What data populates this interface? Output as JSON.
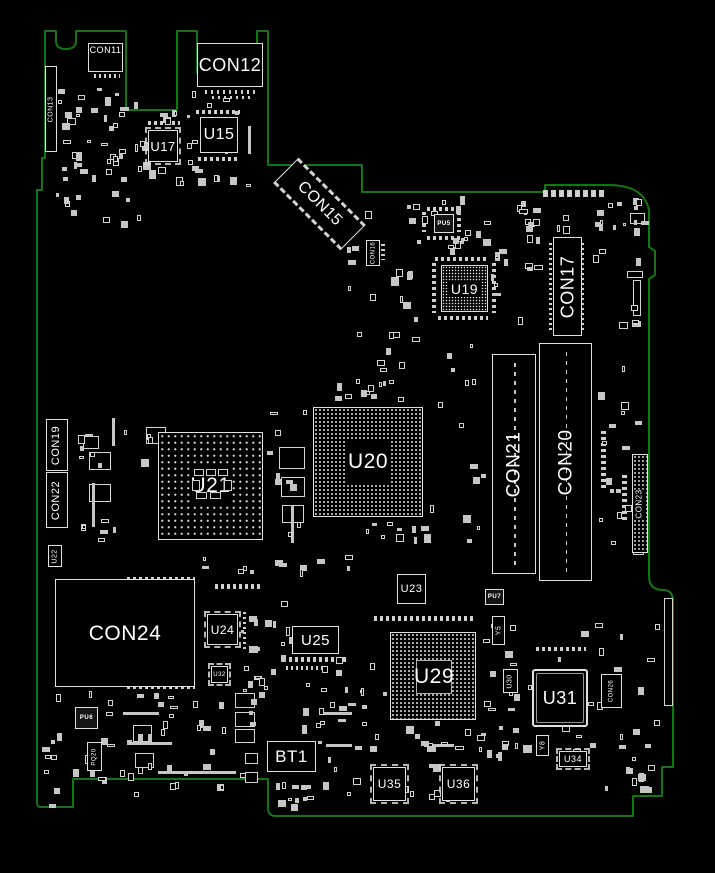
{
  "colors": {
    "background": "#000000",
    "board-outline": "#177317",
    "silkscreen": "#e0e0e0",
    "label": "#ffffff"
  },
  "board": {
    "outline_path": "M45,31 L56,31 L56,41 Q56,49 66,49 Q76,49 76,41 L76,31 L126,31 L126,110 L177,110 L177,31 L197,31 L197,73 L257,73 L257,31 L268,31 L268,165 L362,165 L362,192 L545,192 L545,185 L608,185 Q636,185 645,200 Q649,206 649,212 L649,247 L655,251 L655,275 L649,279 L649,576 Q649,590 663,590 Q673,590 673,601 L673,767 L662,767 L662,796 L633,796 L633,816 L276,816 Q268,816 268,808 L268,779 L73,779 L73,807 L41,807 Q37,807 37,803 L37,190 L42,190 L42,158 L45,158 Z",
    "edge_marker_1": {
      "cx": 199,
      "cy": 73,
      "r": 2.5
    },
    "edge_marker_2": {
      "cx": 255,
      "cy": 73,
      "r": 2.5
    }
  },
  "components": [
    {
      "ref": "CON13",
      "label": "CON13",
      "x": 45,
      "y": 66,
      "w": 12,
      "h": 86,
      "fs": 7,
      "style": "plain",
      "vert": true
    },
    {
      "ref": "CON11",
      "label": "CON11",
      "x": 88,
      "y": 43,
      "w": 35,
      "h": 29,
      "fs": 9,
      "style": "plain",
      "labelTop": true
    },
    {
      "ref": "CON12",
      "label": "CON12",
      "x": 197,
      "y": 43,
      "w": 66,
      "h": 44,
      "fs": 18,
      "style": "plain"
    },
    {
      "ref": "U15",
      "label": "U15",
      "x": 200,
      "y": 117,
      "w": 38,
      "h": 36,
      "fs": 16,
      "style": "plain"
    },
    {
      "ref": "U17",
      "label": "U17",
      "x": 148,
      "y": 130,
      "w": 30,
      "h": 32,
      "fs": 13,
      "style": "qfp"
    },
    {
      "ref": "CON15",
      "label": "CON15",
      "x": 272,
      "y": 186,
      "w": 95,
      "h": 36,
      "fs": 16,
      "style": "diag"
    },
    {
      "ref": "CON16",
      "label": "CON16",
      "x": 366,
      "y": 240,
      "w": 14,
      "h": 26,
      "fs": 6,
      "style": "plain",
      "vert": true
    },
    {
      "ref": "PU5",
      "label": "PU5",
      "x": 434,
      "y": 214,
      "w": 20,
      "h": 19,
      "fs": 6,
      "style": "dark"
    },
    {
      "ref": "U19",
      "label": "U19",
      "x": 441,
      "y": 265,
      "w": 47,
      "h": 47,
      "fs": 14,
      "style": "finegrid"
    },
    {
      "ref": "CON17",
      "label": "CON17",
      "x": 553,
      "y": 237,
      "w": 29,
      "h": 99,
      "fs": 18,
      "style": "plain",
      "vert": true
    },
    {
      "ref": "CON19",
      "label": "CON19",
      "x": 46,
      "y": 419,
      "w": 22,
      "h": 52,
      "fs": 11,
      "style": "plain",
      "vert": true
    },
    {
      "ref": "CON22",
      "label": "CON22",
      "x": 46,
      "y": 472,
      "w": 22,
      "h": 56,
      "fs": 11,
      "style": "plain",
      "vert": true
    },
    {
      "ref": "U22",
      "label": "U22",
      "x": 48,
      "y": 545,
      "w": 14,
      "h": 22,
      "fs": 7,
      "style": "plain",
      "vert": true
    },
    {
      "ref": "U21",
      "label": "U21",
      "x": 158,
      "y": 432,
      "w": 105,
      "h": 108,
      "fs": 21,
      "style": "dots"
    },
    {
      "ref": "U20",
      "label": "U20",
      "x": 313,
      "y": 407,
      "w": 110,
      "h": 110,
      "fs": 21,
      "style": "grid"
    },
    {
      "ref": "CON21",
      "label": "CON21",
      "x": 492,
      "y": 354,
      "w": 44,
      "h": 220,
      "fs": 19,
      "style": "slot",
      "vert": true
    },
    {
      "ref": "CON20",
      "label": "CON20",
      "x": 539,
      "y": 343,
      "w": 53,
      "h": 238,
      "fs": 19,
      "style": "slot",
      "vert": true
    },
    {
      "ref": "CON23",
      "label": "CON23",
      "x": 632,
      "y": 454,
      "w": 16,
      "h": 99,
      "fs": 8,
      "style": "dotted",
      "vert": true
    },
    {
      "ref": "CON24",
      "label": "CON24",
      "x": 55,
      "y": 579,
      "w": 140,
      "h": 108,
      "fs": 21,
      "style": "plain"
    },
    {
      "ref": "U23",
      "label": "U23",
      "x": 397,
      "y": 574,
      "w": 29,
      "h": 30,
      "fs": 11,
      "style": "plain"
    },
    {
      "ref": "U24",
      "label": "U24",
      "x": 207,
      "y": 614,
      "w": 31,
      "h": 31,
      "fs": 12,
      "style": "qfp"
    },
    {
      "ref": "U25",
      "label": "U25",
      "x": 292,
      "y": 626,
      "w": 47,
      "h": 28,
      "fs": 15,
      "style": "plain"
    },
    {
      "ref": "U32",
      "label": "U32",
      "x": 211,
      "y": 666,
      "w": 17,
      "h": 17,
      "fs": 6,
      "style": "qfp"
    },
    {
      "ref": "PU6",
      "label": "PU6",
      "x": 75,
      "y": 707,
      "w": 23,
      "h": 22,
      "fs": 6,
      "style": "dark"
    },
    {
      "ref": "PQ20",
      "label": "PQ20",
      "x": 87,
      "y": 742,
      "w": 15,
      "h": 29,
      "fs": 6,
      "style": "plain",
      "vert": true
    },
    {
      "ref": "U29",
      "label": "U29",
      "x": 390,
      "y": 632,
      "w": 86,
      "h": 88,
      "fs": 21,
      "style": "grid"
    },
    {
      "ref": "PU7",
      "label": "PU7",
      "x": 485,
      "y": 589,
      "w": 19,
      "h": 16,
      "fs": 6,
      "style": "dark"
    },
    {
      "ref": "Y5",
      "label": "Y5",
      "x": 492,
      "y": 616,
      "w": 13,
      "h": 29,
      "fs": 7,
      "style": "plain",
      "vert": true
    },
    {
      "ref": "U30",
      "label": "U30",
      "x": 503,
      "y": 669,
      "w": 15,
      "h": 24,
      "fs": 7,
      "style": "plain",
      "vert": true
    },
    {
      "ref": "U31",
      "label": "U31",
      "x": 532,
      "y": 669,
      "w": 56,
      "h": 58,
      "fs": 18,
      "style": "double"
    },
    {
      "ref": "CON26",
      "label": "CON26",
      "x": 601,
      "y": 674,
      "w": 21,
      "h": 34,
      "fs": 6,
      "style": "plain",
      "vert": true
    },
    {
      "ref": "Y8",
      "label": "Y8",
      "x": 536,
      "y": 735,
      "w": 13,
      "h": 21,
      "fs": 7,
      "style": "plain",
      "vert": true
    },
    {
      "ref": "U34",
      "label": "U34",
      "x": 559,
      "y": 751,
      "w": 28,
      "h": 16,
      "fs": 9,
      "style": "qfp"
    },
    {
      "ref": "BT1",
      "label": "BT1",
      "x": 267,
      "y": 741,
      "w": 49,
      "h": 31,
      "fs": 17,
      "style": "plain"
    },
    {
      "ref": "U35",
      "label": "U35",
      "x": 373,
      "y": 767,
      "w": 33,
      "h": 34,
      "fs": 12,
      "style": "qfp"
    },
    {
      "ref": "U36",
      "label": "U36",
      "x": 442,
      "y": 767,
      "w": 33,
      "h": 34,
      "fs": 12,
      "style": "qfp"
    }
  ]
}
